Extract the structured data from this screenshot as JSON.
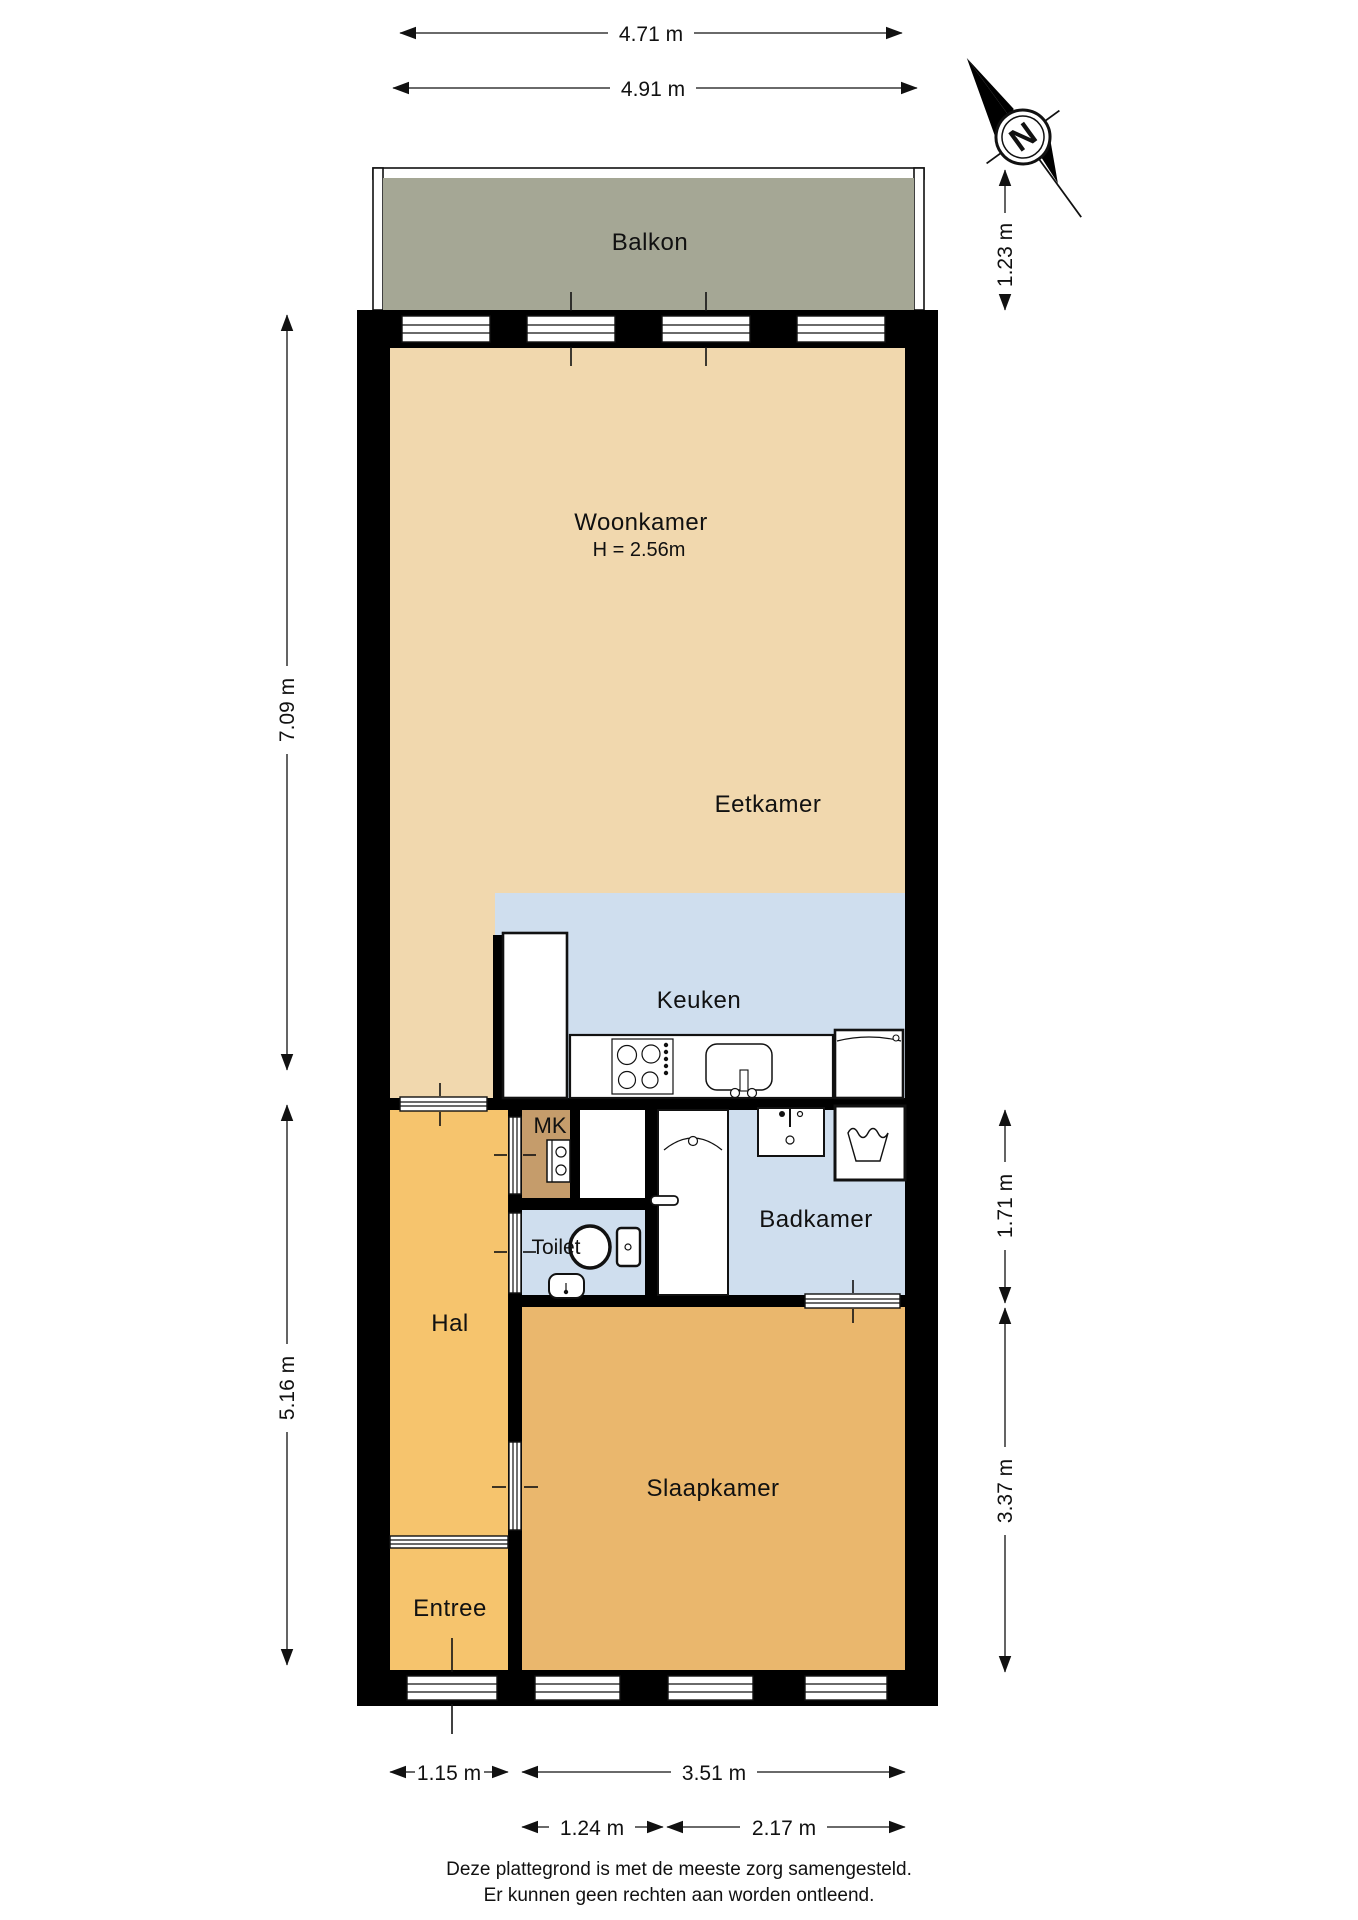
{
  "rooms": {
    "balkon": "Balkon",
    "woonkamer": "Woonkamer",
    "woonkamer_height": "H = 2.56m",
    "eetkamer": "Eetkamer",
    "keuken": "Keuken",
    "mk": "MK",
    "toilet": "Toilet",
    "badkamer": "Badkamer",
    "hal": "Hal",
    "slaapkamer": "Slaapkamer",
    "entree": "Entree"
  },
  "dimensions": {
    "balcony_width": "4.71 m",
    "interior_width": "4.91 m",
    "balcony_depth": "1.23 m",
    "living_depth": "7.09 m",
    "lower_depth": "5.16 m",
    "badkamer_depth": "1.71 m",
    "slaapkamer_depth": "3.37 m",
    "entree_width": "1.15 m",
    "slaapkamer_width": "3.51 m",
    "window_section_left": "1.24 m",
    "window_section_right": "2.17 m"
  },
  "compass": {
    "north_label": "N"
  },
  "footer": {
    "line1": "Deze plattegrond is met de meeste zorg samengesteld.",
    "line2": "Er kunnen geen rechten aan worden ontleend."
  },
  "colors": {
    "background": "#ffffff",
    "wall": "#000000",
    "living": "#F1D8AE",
    "wet_rooms": "#CFDEEE",
    "hall": "#F6C46D",
    "bedroom": "#EAB76D",
    "balcony": "#A5A795",
    "meter_closet": "#C59C6B"
  }
}
